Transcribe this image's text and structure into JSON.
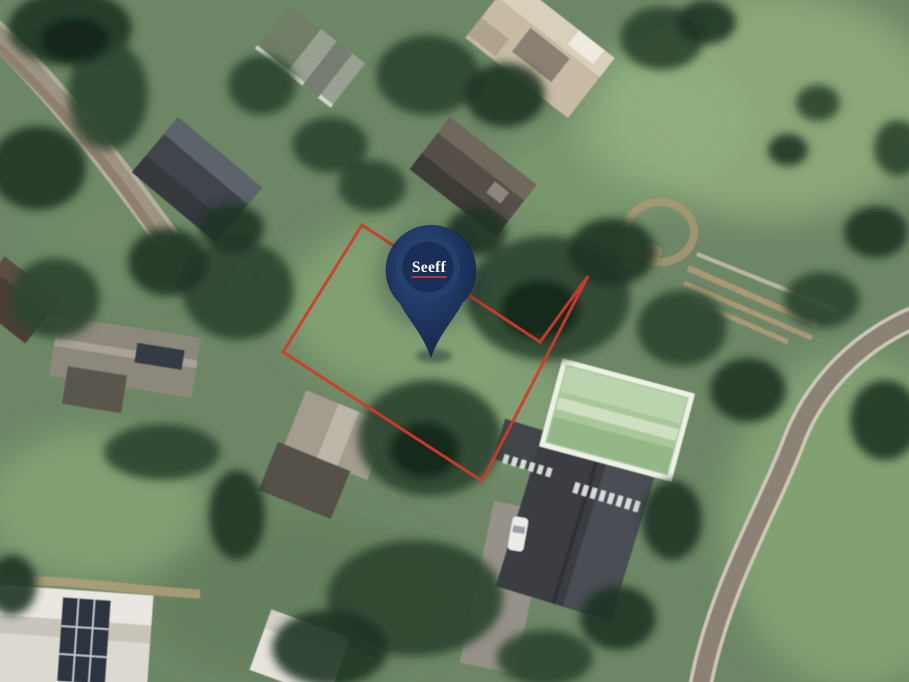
{
  "map": {
    "view": "satellite-aerial",
    "description": "Aerial satellite photo of a leafy suburban neighbourhood. A vacant, partly tree-covered plot is outlined in red and marked with a navy Seeff estate-agency map pin.",
    "landmarks": [
      "charcoal-roof house top left",
      "beige-roof house top centre-right",
      "grey-roof house above the plot",
      "light-green-roof house right of the plot",
      "large charcoal roof with white roof windows bottom centre",
      "white flat-roof house with solar panels bottom left",
      "grey gabled house with solar panels middle left",
      "white car on grey driveway",
      "curved road bottom right",
      "dirt road top left",
      "round dirt turning circle top right",
      "tan garden terraces right of plot"
    ]
  },
  "pin": {
    "label": "Seeff",
    "label_color": "#f7f6f2",
    "underline_color": "#c23b38",
    "body_color_dark": "#142545",
    "body_color": "#1e3560",
    "body_color_light": "#2e4a79",
    "ring_color": "#25406d",
    "inner_disc_color": "#1a2f57",
    "tip_x": 431,
    "tip_y": 357
  },
  "boundary": {
    "color": "#d23a2b",
    "stroke_width": 3,
    "points": "362,225 540,342 588,276 482,481 283,352"
  }
}
